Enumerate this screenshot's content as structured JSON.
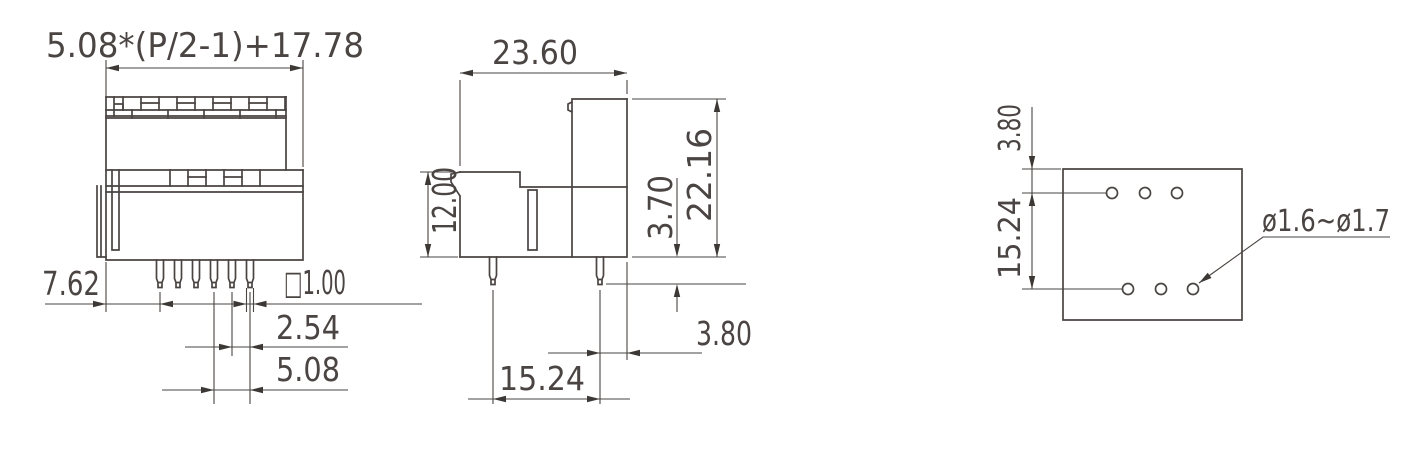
{
  "drawing": {
    "background": "#ffffff",
    "line_color": "#4a4442",
    "arrow_color": "#3c3835",
    "views": {
      "front": {
        "label": "front-view",
        "dims": {
          "total_width_formula": "5.08*(P/2-1)+17.78",
          "edge_to_first_pin": "7.62",
          "pin_cross_section": "□1.00",
          "adjacent_pin_pitch": "2.54",
          "row_pin_pitch": "5.08"
        }
      },
      "side": {
        "label": "side-view",
        "dims": {
          "depth": "23.60",
          "front_height": "12.00",
          "pin_length": "3.70",
          "total_height": "22.16",
          "pin_to_back_edge": "3.80",
          "pin_row_spacing": "15.24"
        }
      },
      "bottom": {
        "label": "bottom-footprint-view",
        "dims": {
          "edge_to_first_row": "3.80",
          "row_spacing": "15.24",
          "hole_diameter_range": "ø1.6~ø1.7"
        }
      }
    }
  }
}
